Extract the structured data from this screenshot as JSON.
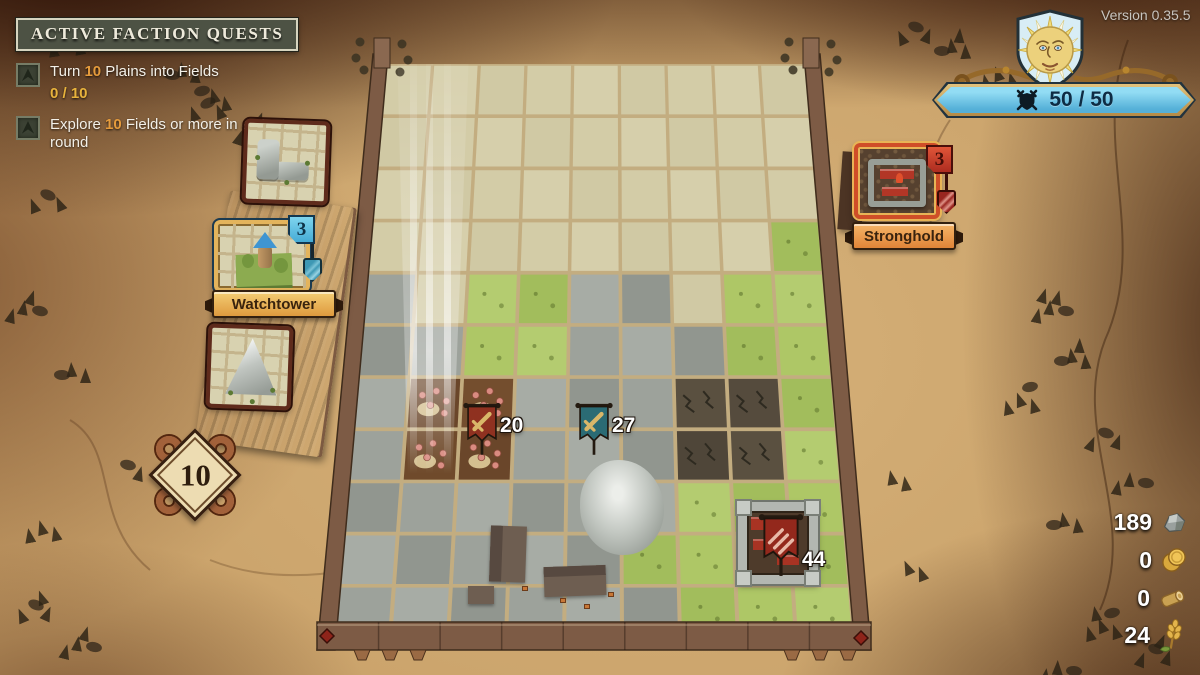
{
  "version_label": "Version 0.35.5",
  "quest_panel": {
    "title": "ACTIVE FACTION QUESTS",
    "quests": [
      {
        "pre": "Turn ",
        "highlight": "10",
        "post": " Plains into Fields",
        "progress": "0 / 10"
      },
      {
        "pre": "Explore ",
        "highlight": "10",
        "post": " Fields or more in a single round",
        "progress": ""
      }
    ]
  },
  "battle_banner": {
    "value": "50 / 50",
    "icon": "crossed-swords-shield"
  },
  "hand": {
    "deck_count": "10",
    "cards": [
      {
        "title": "",
        "kind": "rock-corner-tile",
        "cost": ""
      },
      {
        "title": "Watchtower",
        "kind": "watchtower-tile",
        "cost": "3",
        "selected": true
      },
      {
        "title": "",
        "kind": "mountain-tile",
        "cost": ""
      }
    ]
  },
  "enemy": {
    "card": {
      "title": "Stronghold",
      "kind": "stronghold-tile",
      "cost": "3"
    }
  },
  "units": [
    {
      "id": "red-army",
      "emblem": "sword",
      "value": "20",
      "color": "#8f3120"
    },
    {
      "id": "blue-army",
      "emblem": "sword",
      "value": "27",
      "color": "#2b6b74"
    },
    {
      "id": "enemy-stronghold-flag",
      "emblem": "claws",
      "value": "44",
      "color": "#93281c"
    }
  ],
  "resources": [
    {
      "name": "stone",
      "value": "189"
    },
    {
      "name": "gold",
      "value": "0"
    },
    {
      "name": "wood",
      "value": "0"
    },
    {
      "name": "wheat",
      "value": "24"
    }
  ],
  "board": {
    "cols": 9,
    "rows": 11,
    "tiles": [
      "EEEEEEEEE",
      "EEEEEEEEE",
      "EEEEEEEEE",
      "EEEEEEEEG",
      "REGGRREGG",
      "RRGGRRRGG",
      "RBBRRRDDG",
      "RBBRRRDDG",
      "RRRRRRGGG",
      "RRRRRGGGG",
      "RRRRRRGGG"
    ],
    "palette": {
      "E": "#d3cca7",
      "G": "#abc468",
      "R": "#9da29b",
      "B": "#6f4a2b",
      "D": "#55483a"
    },
    "gap_color": "#c3ad80",
    "frame_color": "#7d5b45"
  }
}
